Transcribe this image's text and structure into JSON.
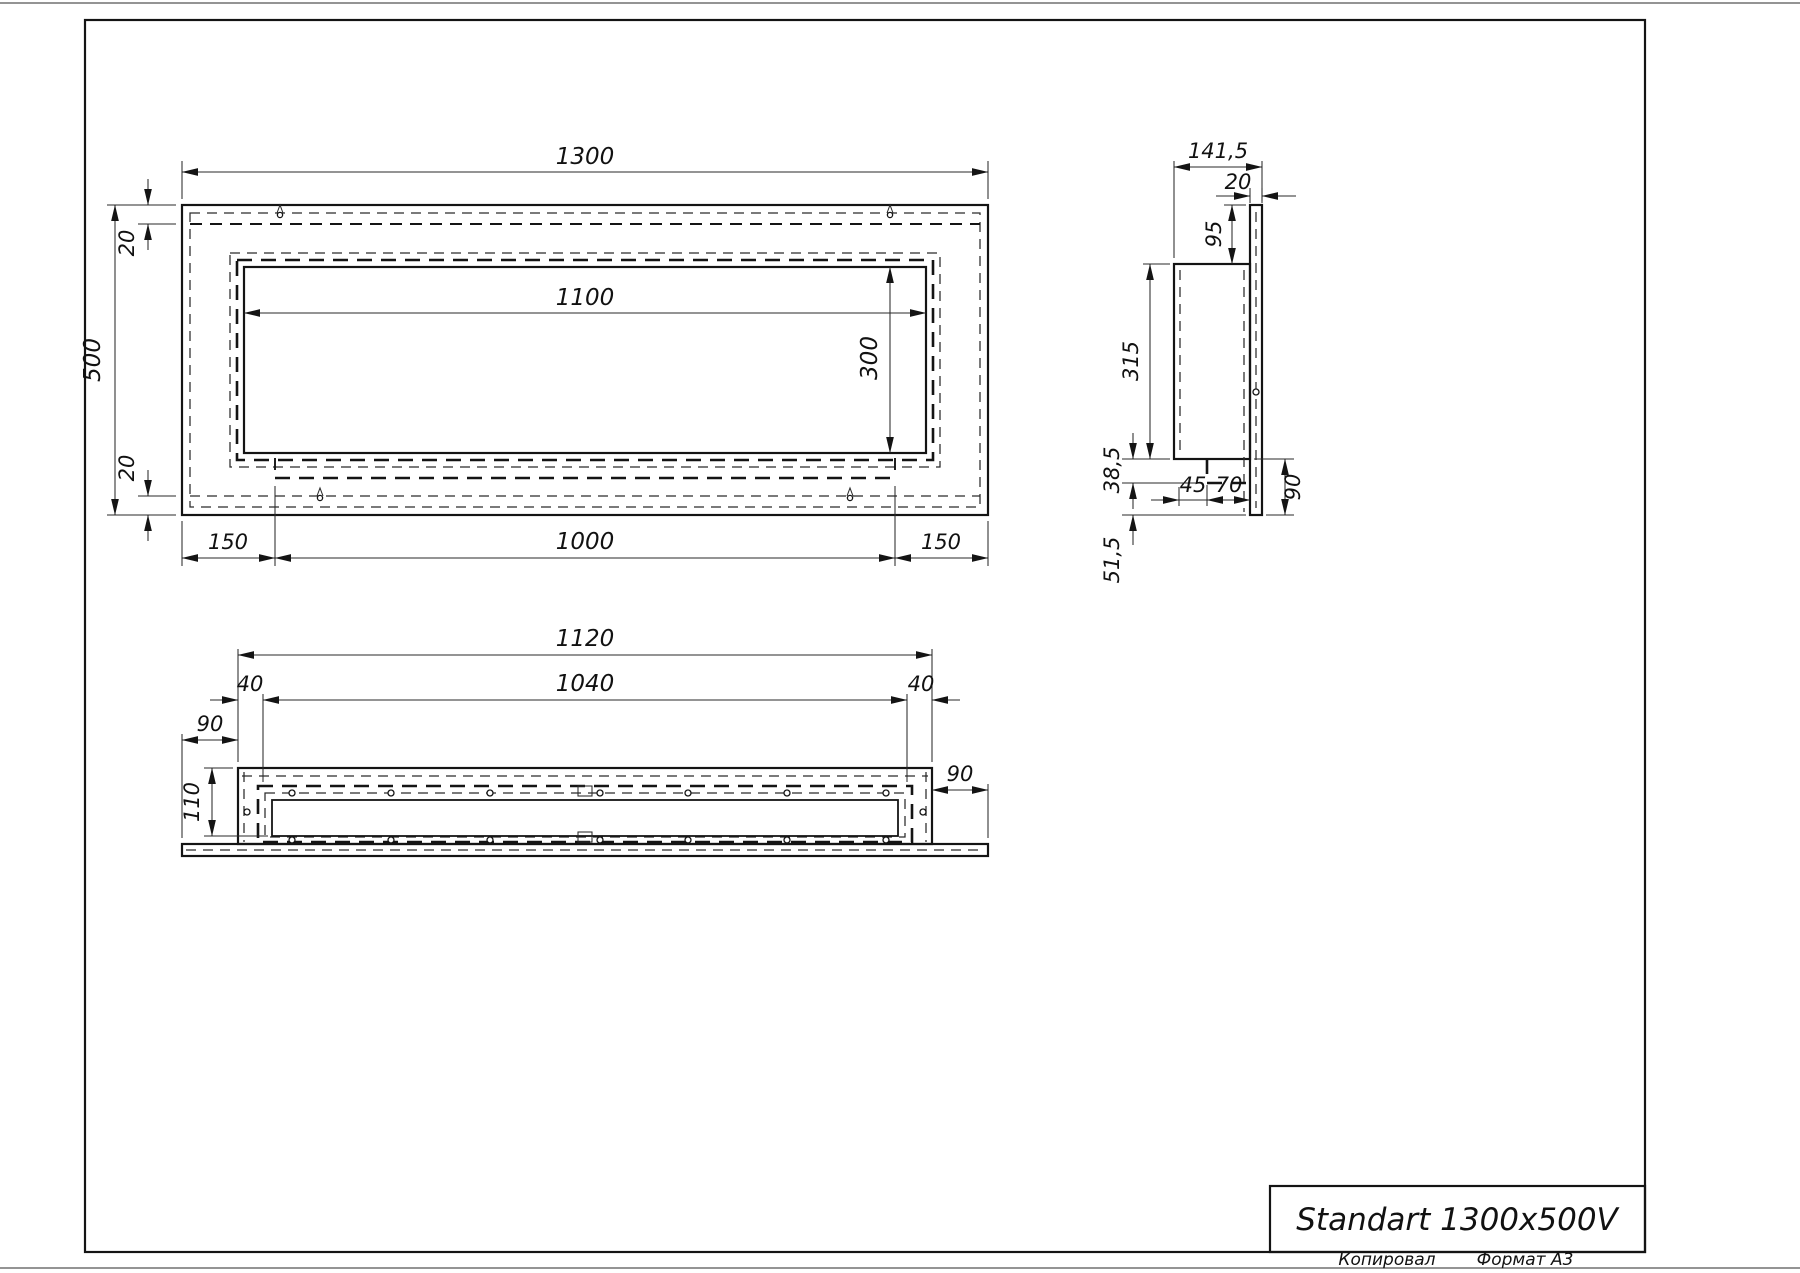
{
  "title_block": {
    "title": "Standart 1300x500V"
  },
  "footer": {
    "copied_label": "Копировал",
    "format_label": "Формат А3"
  },
  "front_view": {
    "overall_width": "1300",
    "overall_height": "500",
    "top_offset": "20",
    "bottom_offset": "20",
    "opening_width": "1100",
    "opening_height": "300",
    "side_margin_left": "150",
    "inner_box_width": "1000",
    "side_margin_right": "150"
  },
  "side_view": {
    "overall_depth": "141,5",
    "flange_thickness": "20",
    "top_offset": "95",
    "body_height": "315",
    "shelf_height": "38,5",
    "bottom_offset": "51,5",
    "shelf_inset": "45",
    "shelf_depth": "70",
    "flange_overhang": "90"
  },
  "bottom_view": {
    "body_width": "1120",
    "opening_width": "1040",
    "margin_left": "40",
    "margin_right": "40",
    "flange_ext_left": "90",
    "flange_ext_right": "90",
    "body_depth": "110"
  }
}
